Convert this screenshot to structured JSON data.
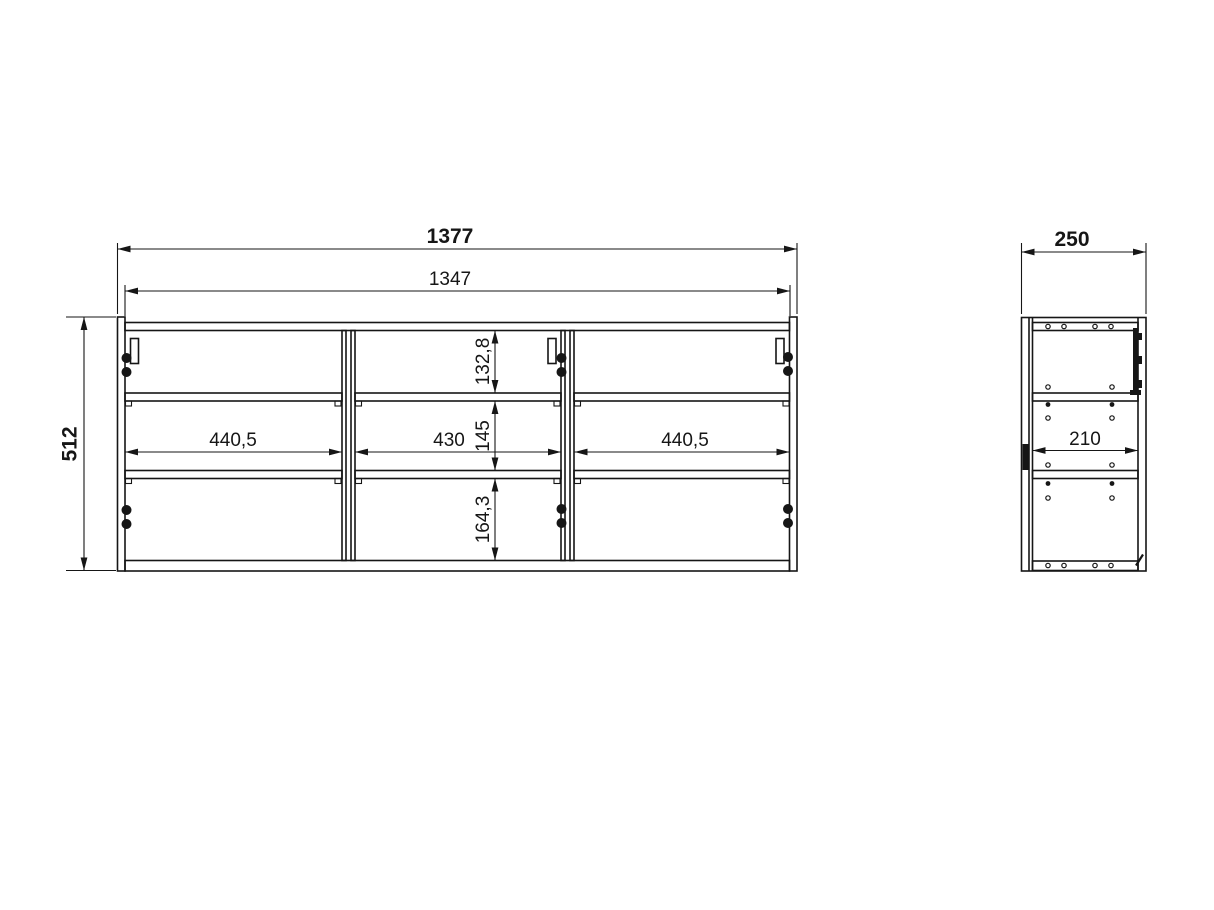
{
  "colors": {
    "ink": "#161616",
    "paper": "#ffffff"
  },
  "front_view": {
    "overall_width": "1377",
    "inner_width": "1347",
    "overall_height": "512",
    "compartments": {
      "left_width": "440,5",
      "middle_width": "430",
      "right_width": "440,5"
    },
    "rows": {
      "top_height": "132,8",
      "middle_height": "145",
      "bottom_height": "164,3"
    }
  },
  "side_view": {
    "depth": "250",
    "inner_depth": "210"
  }
}
